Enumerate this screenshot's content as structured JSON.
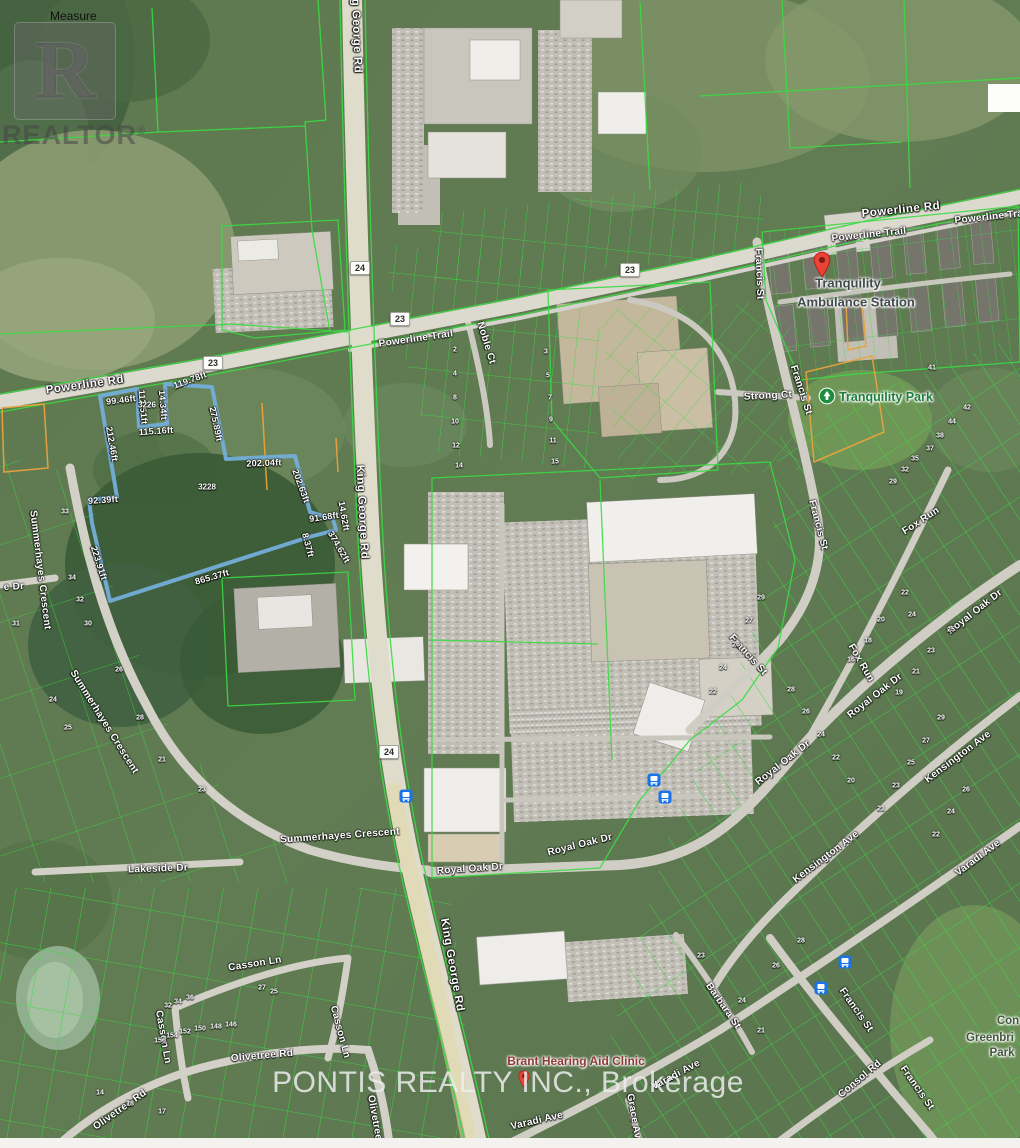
{
  "map": {
    "width": 1020,
    "height": 1148
  },
  "watermarks": {
    "measure_label": "Measure",
    "realtor_logo_letter": "R",
    "realtor_text": "REALTOR",
    "realtor_registered": "®",
    "brokerage_text": "PONTIS REALTY INC., Brokerage"
  },
  "highway_shields": [
    {
      "label": "24",
      "x": 360,
      "y": 268
    },
    {
      "label": "23",
      "x": 400,
      "y": 319
    },
    {
      "label": "23",
      "x": 630,
      "y": 270
    },
    {
      "label": "23",
      "x": 213,
      "y": 363
    },
    {
      "label": "24",
      "x": 389,
      "y": 752
    }
  ],
  "road_labels": [
    {
      "text": "Powerline Rd",
      "x": 85,
      "y": 385,
      "rot": -8,
      "cls": "road"
    },
    {
      "text": "Powerline Rd",
      "x": 901,
      "y": 210,
      "rot": -6,
      "cls": "road"
    },
    {
      "text": "Powerline Trail",
      "x": 869,
      "y": 235,
      "rot": -6,
      "cls": "roadsm"
    },
    {
      "text": "Powerline Trail",
      "x": 992,
      "y": 217,
      "rot": -6,
      "cls": "roadsm"
    },
    {
      "text": "Powerline Trail",
      "x": 416,
      "y": 339,
      "rot": -8,
      "cls": "roadsm"
    },
    {
      "text": "King George Rd",
      "x": 356,
      "y": 26,
      "rot": 88,
      "cls": "road"
    },
    {
      "text": "King George Rd",
      "x": 362,
      "y": 512,
      "rot": 87,
      "cls": "road"
    },
    {
      "text": "King George Rd",
      "x": 452,
      "y": 965,
      "rot": 80,
      "cls": "road"
    },
    {
      "text": "Noble Ct",
      "x": 486,
      "y": 343,
      "rot": 73,
      "cls": "roadsm"
    },
    {
      "text": "Strong Ct",
      "x": 768,
      "y": 396,
      "rot": -3,
      "cls": "roadsm"
    },
    {
      "text": "Francis St",
      "x": 759,
      "y": 274,
      "rot": 88,
      "cls": "roadsm"
    },
    {
      "text": "Francis St",
      "x": 801,
      "y": 390,
      "rot": 72,
      "cls": "roadsm"
    },
    {
      "text": "Francis St",
      "x": 818,
      "y": 525,
      "rot": 75,
      "cls": "roadsm"
    },
    {
      "text": "Francis St",
      "x": 748,
      "y": 655,
      "rot": 48,
      "cls": "roadsm"
    },
    {
      "text": "Francis St",
      "x": 856,
      "y": 1010,
      "rot": 55,
      "cls": "roadsm"
    },
    {
      "text": "Francis St",
      "x": 917,
      "y": 1088,
      "rot": 55,
      "cls": "roadsm"
    },
    {
      "text": "Fox Run",
      "x": 921,
      "y": 521,
      "rot": -33,
      "cls": "roadsm"
    },
    {
      "text": "Fox Run",
      "x": 861,
      "y": 663,
      "rot": 60,
      "cls": "roadsm"
    },
    {
      "text": "Royal Oak Dr",
      "x": 470,
      "y": 869,
      "rot": -4,
      "cls": "roadsm"
    },
    {
      "text": "Royal Oak Dr",
      "x": 580,
      "y": 845,
      "rot": -14,
      "cls": "roadsm"
    },
    {
      "text": "Royal Oak Dr",
      "x": 783,
      "y": 763,
      "rot": -38,
      "cls": "roadsm"
    },
    {
      "text": "Royal Oak Dr",
      "x": 875,
      "y": 696,
      "rot": -38,
      "cls": "roadsm"
    },
    {
      "text": "Royal Oak Dr",
      "x": 975,
      "y": 612,
      "rot": -38,
      "cls": "roadsm"
    },
    {
      "text": "Kensington Ave",
      "x": 958,
      "y": 757,
      "rot": -37,
      "cls": "roadsm"
    },
    {
      "text": "Kensington Ave",
      "x": 826,
      "y": 857,
      "rot": -37,
      "cls": "roadsm"
    },
    {
      "text": "Varadi Ave",
      "x": 978,
      "y": 858,
      "rot": -37,
      "cls": "roadsm"
    },
    {
      "text": "Varadi Ave",
      "x": 537,
      "y": 1121,
      "rot": -13,
      "cls": "roadsm"
    },
    {
      "text": "Varadi Ave",
      "x": 676,
      "y": 1075,
      "rot": -28,
      "cls": "roadsm"
    },
    {
      "text": "Summerhayes Crescent",
      "x": 40,
      "y": 570,
      "rot": 83,
      "cls": "roadsm"
    },
    {
      "text": "Summerhayes Crescent",
      "x": 104,
      "y": 722,
      "rot": 58,
      "cls": "roadsm"
    },
    {
      "text": "Summerhayes Crescent",
      "x": 340,
      "y": 836,
      "rot": -4,
      "cls": "roadsm"
    },
    {
      "text": "Lakeside Dr",
      "x": 158,
      "y": 869,
      "rot": -2,
      "cls": "roadsm"
    },
    {
      "text": "e Dr",
      "x": 14,
      "y": 587,
      "rot": -3,
      "cls": "roadsm"
    },
    {
      "text": "Casson Ln",
      "x": 255,
      "y": 964,
      "rot": -9,
      "cls": "roadsm"
    },
    {
      "text": "Casson Ln",
      "x": 163,
      "y": 1037,
      "rot": 80,
      "cls": "roadsm"
    },
    {
      "text": "Casson Ln",
      "x": 340,
      "y": 1032,
      "rot": 75,
      "cls": "roadsm"
    },
    {
      "text": "Olivetree Rd",
      "x": 262,
      "y": 1056,
      "rot": -5,
      "cls": "roadsm"
    },
    {
      "text": "Olivetree Rd",
      "x": 120,
      "y": 1110,
      "rot": -35,
      "cls": "roadsm"
    },
    {
      "text": "Olivetree Rd",
      "x": 376,
      "y": 1126,
      "rot": 80,
      "cls": "roadsm"
    },
    {
      "text": "Barbara St",
      "x": 723,
      "y": 1006,
      "rot": 55,
      "cls": "roadsm"
    },
    {
      "text": "Consol Rd",
      "x": 860,
      "y": 1079,
      "rot": -40,
      "cls": "roadsm"
    },
    {
      "text": "Grace Ave",
      "x": 634,
      "y": 1119,
      "rot": 80,
      "cls": "roadsm"
    }
  ],
  "pois": {
    "ambulance_station": {
      "line1": "Tranquility",
      "line2": "Ambulance Station"
    },
    "park": {
      "label": "Tranquility Park"
    },
    "clinic": {
      "label": "Brant Hearing Aid Clinic"
    },
    "corner_park": {
      "line1": "Con",
      "line2": "Greenbri",
      "line3": "Park"
    }
  },
  "subject_parcel": {
    "outline_color": "#74add9",
    "parcel_ids": [
      {
        "label": "3226",
        "x": 147,
        "y": 405
      },
      {
        "label": "3228",
        "x": 207,
        "y": 487
      }
    ],
    "measurements": [
      {
        "text": "99.46ft",
        "x": 121,
        "y": 400,
        "rot": -7
      },
      {
        "text": "119.78ft",
        "x": 190,
        "y": 380,
        "rot": -20
      },
      {
        "text": "14.34ft",
        "x": 163,
        "y": 405,
        "rot": 85
      },
      {
        "text": "112.51ft",
        "x": 143,
        "y": 407,
        "rot": 85
      },
      {
        "text": "115.16ft",
        "x": 156,
        "y": 431,
        "rot": -4
      },
      {
        "text": "275.89ft",
        "x": 216,
        "y": 424,
        "rot": 78
      },
      {
        "text": "202.04ft",
        "x": 264,
        "y": 463,
        "rot": -2
      },
      {
        "text": "202.63ft",
        "x": 301,
        "y": 486,
        "rot": 70
      },
      {
        "text": "91.68ft",
        "x": 324,
        "y": 517,
        "rot": -8
      },
      {
        "text": "14.62ft",
        "x": 344,
        "y": 516,
        "rot": 80
      },
      {
        "text": "374.62ft",
        "x": 339,
        "y": 547,
        "rot": 60
      },
      {
        "text": "8.37ft",
        "x": 308,
        "y": 545,
        "rot": 75
      },
      {
        "text": "865.37ft",
        "x": 212,
        "y": 577,
        "rot": -16
      },
      {
        "text": "212.46ft",
        "x": 112,
        "y": 444,
        "rot": 80
      },
      {
        "text": "92.39ft",
        "x": 103,
        "y": 500,
        "rot": -4
      },
      {
        "text": "223.91ft",
        "x": 99,
        "y": 563,
        "rot": 72
      }
    ]
  },
  "lot_numbers": [
    {
      "n": "2",
      "x": 455,
      "y": 350
    },
    {
      "n": "4",
      "x": 455,
      "y": 374
    },
    {
      "n": "8",
      "x": 455,
      "y": 398
    },
    {
      "n": "10",
      "x": 455,
      "y": 422
    },
    {
      "n": "12",
      "x": 456,
      "y": 446
    },
    {
      "n": "14",
      "x": 459,
      "y": 466
    },
    {
      "n": "3",
      "x": 546,
      "y": 352
    },
    {
      "n": "5",
      "x": 548,
      "y": 376
    },
    {
      "n": "7",
      "x": 550,
      "y": 398
    },
    {
      "n": "9",
      "x": 551,
      "y": 420
    },
    {
      "n": "11",
      "x": 553,
      "y": 441
    },
    {
      "n": "15",
      "x": 555,
      "y": 462
    },
    {
      "n": "41",
      "x": 932,
      "y": 368
    },
    {
      "n": "42",
      "x": 967,
      "y": 408
    },
    {
      "n": "44",
      "x": 952,
      "y": 422
    },
    {
      "n": "38",
      "x": 940,
      "y": 436
    },
    {
      "n": "37",
      "x": 930,
      "y": 449
    },
    {
      "n": "35",
      "x": 915,
      "y": 459
    },
    {
      "n": "32",
      "x": 905,
      "y": 470
    },
    {
      "n": "29",
      "x": 893,
      "y": 482
    },
    {
      "n": "33",
      "x": 65,
      "y": 512
    },
    {
      "n": "34",
      "x": 72,
      "y": 578
    },
    {
      "n": "32",
      "x": 80,
      "y": 600
    },
    {
      "n": "31",
      "x": 16,
      "y": 624
    },
    {
      "n": "30",
      "x": 88,
      "y": 624
    },
    {
      "n": "26",
      "x": 119,
      "y": 670
    },
    {
      "n": "28",
      "x": 140,
      "y": 718
    },
    {
      "n": "24",
      "x": 53,
      "y": 700
    },
    {
      "n": "25",
      "x": 68,
      "y": 728
    },
    {
      "n": "21",
      "x": 162,
      "y": 760
    },
    {
      "n": "23",
      "x": 202,
      "y": 790
    },
    {
      "n": "27",
      "x": 262,
      "y": 988
    },
    {
      "n": "25",
      "x": 274,
      "y": 992
    },
    {
      "n": "34",
      "x": 178,
      "y": 1002
    },
    {
      "n": "32",
      "x": 168,
      "y": 1006
    },
    {
      "n": "36",
      "x": 190,
      "y": 998
    },
    {
      "n": "152",
      "x": 185,
      "y": 1032
    },
    {
      "n": "154",
      "x": 172,
      "y": 1036
    },
    {
      "n": "150",
      "x": 200,
      "y": 1029
    },
    {
      "n": "148",
      "x": 216,
      "y": 1027
    },
    {
      "n": "146",
      "x": 231,
      "y": 1025
    },
    {
      "n": "156",
      "x": 160,
      "y": 1041
    },
    {
      "n": "14",
      "x": 100,
      "y": 1093
    },
    {
      "n": "18",
      "x": 130,
      "y": 1104
    },
    {
      "n": "17",
      "x": 162,
      "y": 1112
    },
    {
      "n": "22",
      "x": 905,
      "y": 593
    },
    {
      "n": "24",
      "x": 912,
      "y": 615
    },
    {
      "n": "20",
      "x": 881,
      "y": 620
    },
    {
      "n": "18",
      "x": 868,
      "y": 641
    },
    {
      "n": "16",
      "x": 851,
      "y": 660
    },
    {
      "n": "23",
      "x": 931,
      "y": 651
    },
    {
      "n": "21",
      "x": 916,
      "y": 672
    },
    {
      "n": "19",
      "x": 899,
      "y": 693
    },
    {
      "n": "25",
      "x": 951,
      "y": 630
    },
    {
      "n": "29",
      "x": 761,
      "y": 598
    },
    {
      "n": "27",
      "x": 749,
      "y": 621
    },
    {
      "n": "26",
      "x": 736,
      "y": 645
    },
    {
      "n": "24",
      "x": 723,
      "y": 668
    },
    {
      "n": "22",
      "x": 713,
      "y": 692
    },
    {
      "n": "28",
      "x": 791,
      "y": 690
    },
    {
      "n": "26",
      "x": 806,
      "y": 712
    },
    {
      "n": "24",
      "x": 821,
      "y": 735
    },
    {
      "n": "22",
      "x": 836,
      "y": 758
    },
    {
      "n": "20",
      "x": 851,
      "y": 781
    },
    {
      "n": "29",
      "x": 941,
      "y": 718
    },
    {
      "n": "27",
      "x": 926,
      "y": 741
    },
    {
      "n": "25",
      "x": 911,
      "y": 763
    },
    {
      "n": "23",
      "x": 896,
      "y": 786
    },
    {
      "n": "21",
      "x": 881,
      "y": 809
    },
    {
      "n": "26",
      "x": 966,
      "y": 790
    },
    {
      "n": "24",
      "x": 951,
      "y": 812
    },
    {
      "n": "22",
      "x": 936,
      "y": 835
    },
    {
      "n": "24",
      "x": 742,
      "y": 1001
    },
    {
      "n": "21",
      "x": 761,
      "y": 1031
    },
    {
      "n": "23",
      "x": 701,
      "y": 956
    },
    {
      "n": "26",
      "x": 776,
      "y": 966
    },
    {
      "n": "28",
      "x": 801,
      "y": 941
    }
  ],
  "transit_stops": [
    {
      "x": 406,
      "y": 796
    },
    {
      "x": 654,
      "y": 780
    },
    {
      "x": 665,
      "y": 797
    },
    {
      "x": 845,
      "y": 962
    },
    {
      "x": 821,
      "y": 988
    }
  ]
}
